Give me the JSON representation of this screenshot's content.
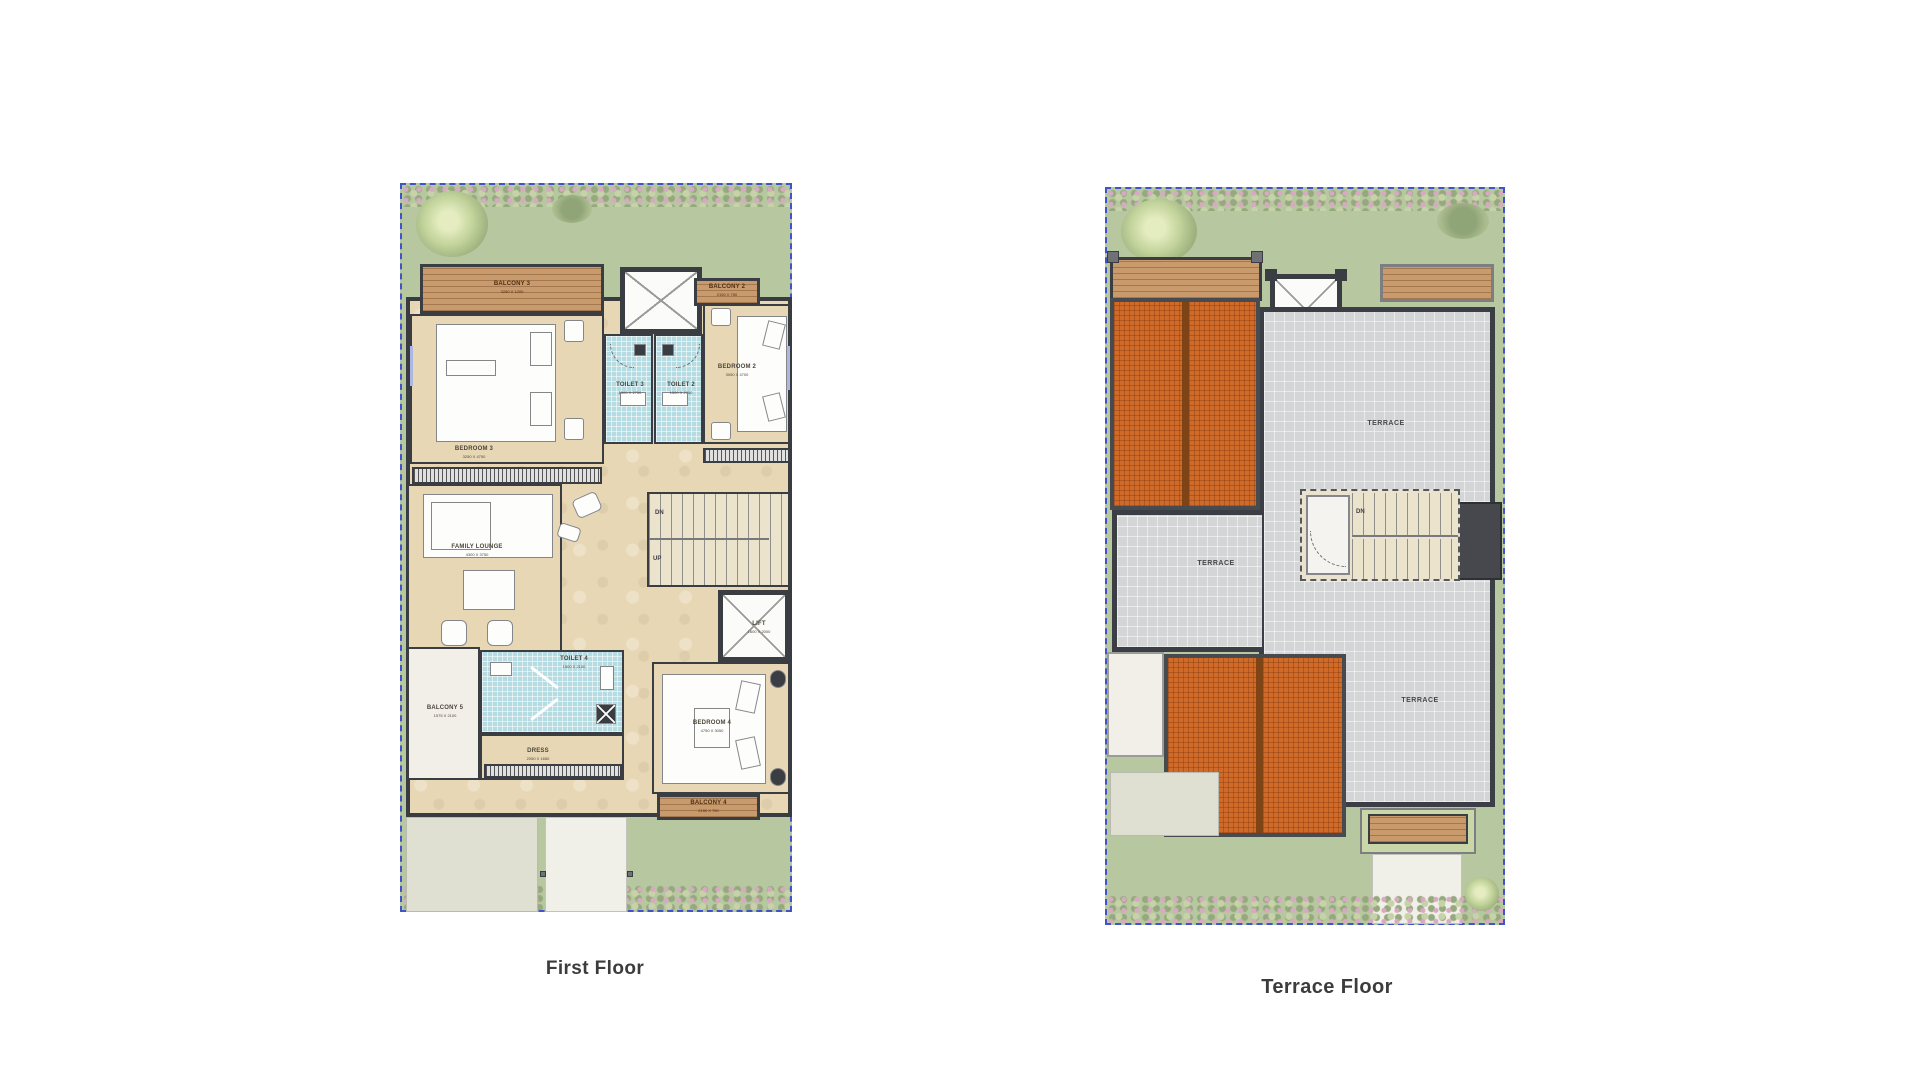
{
  "titles": {
    "first": "First Floor",
    "terrace": "Terrace Floor"
  },
  "first_floor": {
    "balcony3": {
      "name": "BALCONY 3",
      "dim": "3280 X 1200"
    },
    "balcony2": {
      "name": "BALCONY 2",
      "dim": "2150 X 750"
    },
    "bedroom3": {
      "name": "BEDROOM 3",
      "dim": "3250 X 4750"
    },
    "toilet3": {
      "name": "TOILET 3",
      "dim": "1500 X 2750"
    },
    "toilet2": {
      "name": "TOILET 2",
      "dim": "1500 X 2750"
    },
    "bedroom2": {
      "name": "BEDROOM 2",
      "dim": "3050 X 4700"
    },
    "family_lounge": {
      "name": "FAMILY LOUNGE",
      "dim": "4300 X 3750"
    },
    "stairs": {
      "dn": "DN",
      "up": "UP"
    },
    "lift": {
      "name": "LIFT",
      "dim": "1600 X 2000"
    },
    "toilet4": {
      "name": "TOILET 4",
      "dim": "1500 X 2100"
    },
    "balcony5": {
      "name": "BALCONY 5",
      "dim": "1575 X 2100"
    },
    "dress": {
      "name": "DRESS",
      "dim": "2050 X 1650"
    },
    "bedroom4": {
      "name": "BEDROOM 4",
      "dim": "4750 X 3050"
    },
    "balcony4": {
      "name": "BALCONY 4",
      "dim": "2150 X 750"
    }
  },
  "terrace_floor": {
    "terrace_top": "TERRACE",
    "terrace_left": "TERRACE",
    "terrace_bottom": "TERRACE",
    "dn": "DN"
  },
  "colors": {
    "plot_border": "#4053c8",
    "garden": "#b7c7a0",
    "wall": "#3a3d42",
    "floor": "#e7d7b5",
    "wood": "#c89a6c",
    "tile": "#b5dbe3",
    "roof": "#cf6a28",
    "terrace": "#d4d5d7"
  }
}
